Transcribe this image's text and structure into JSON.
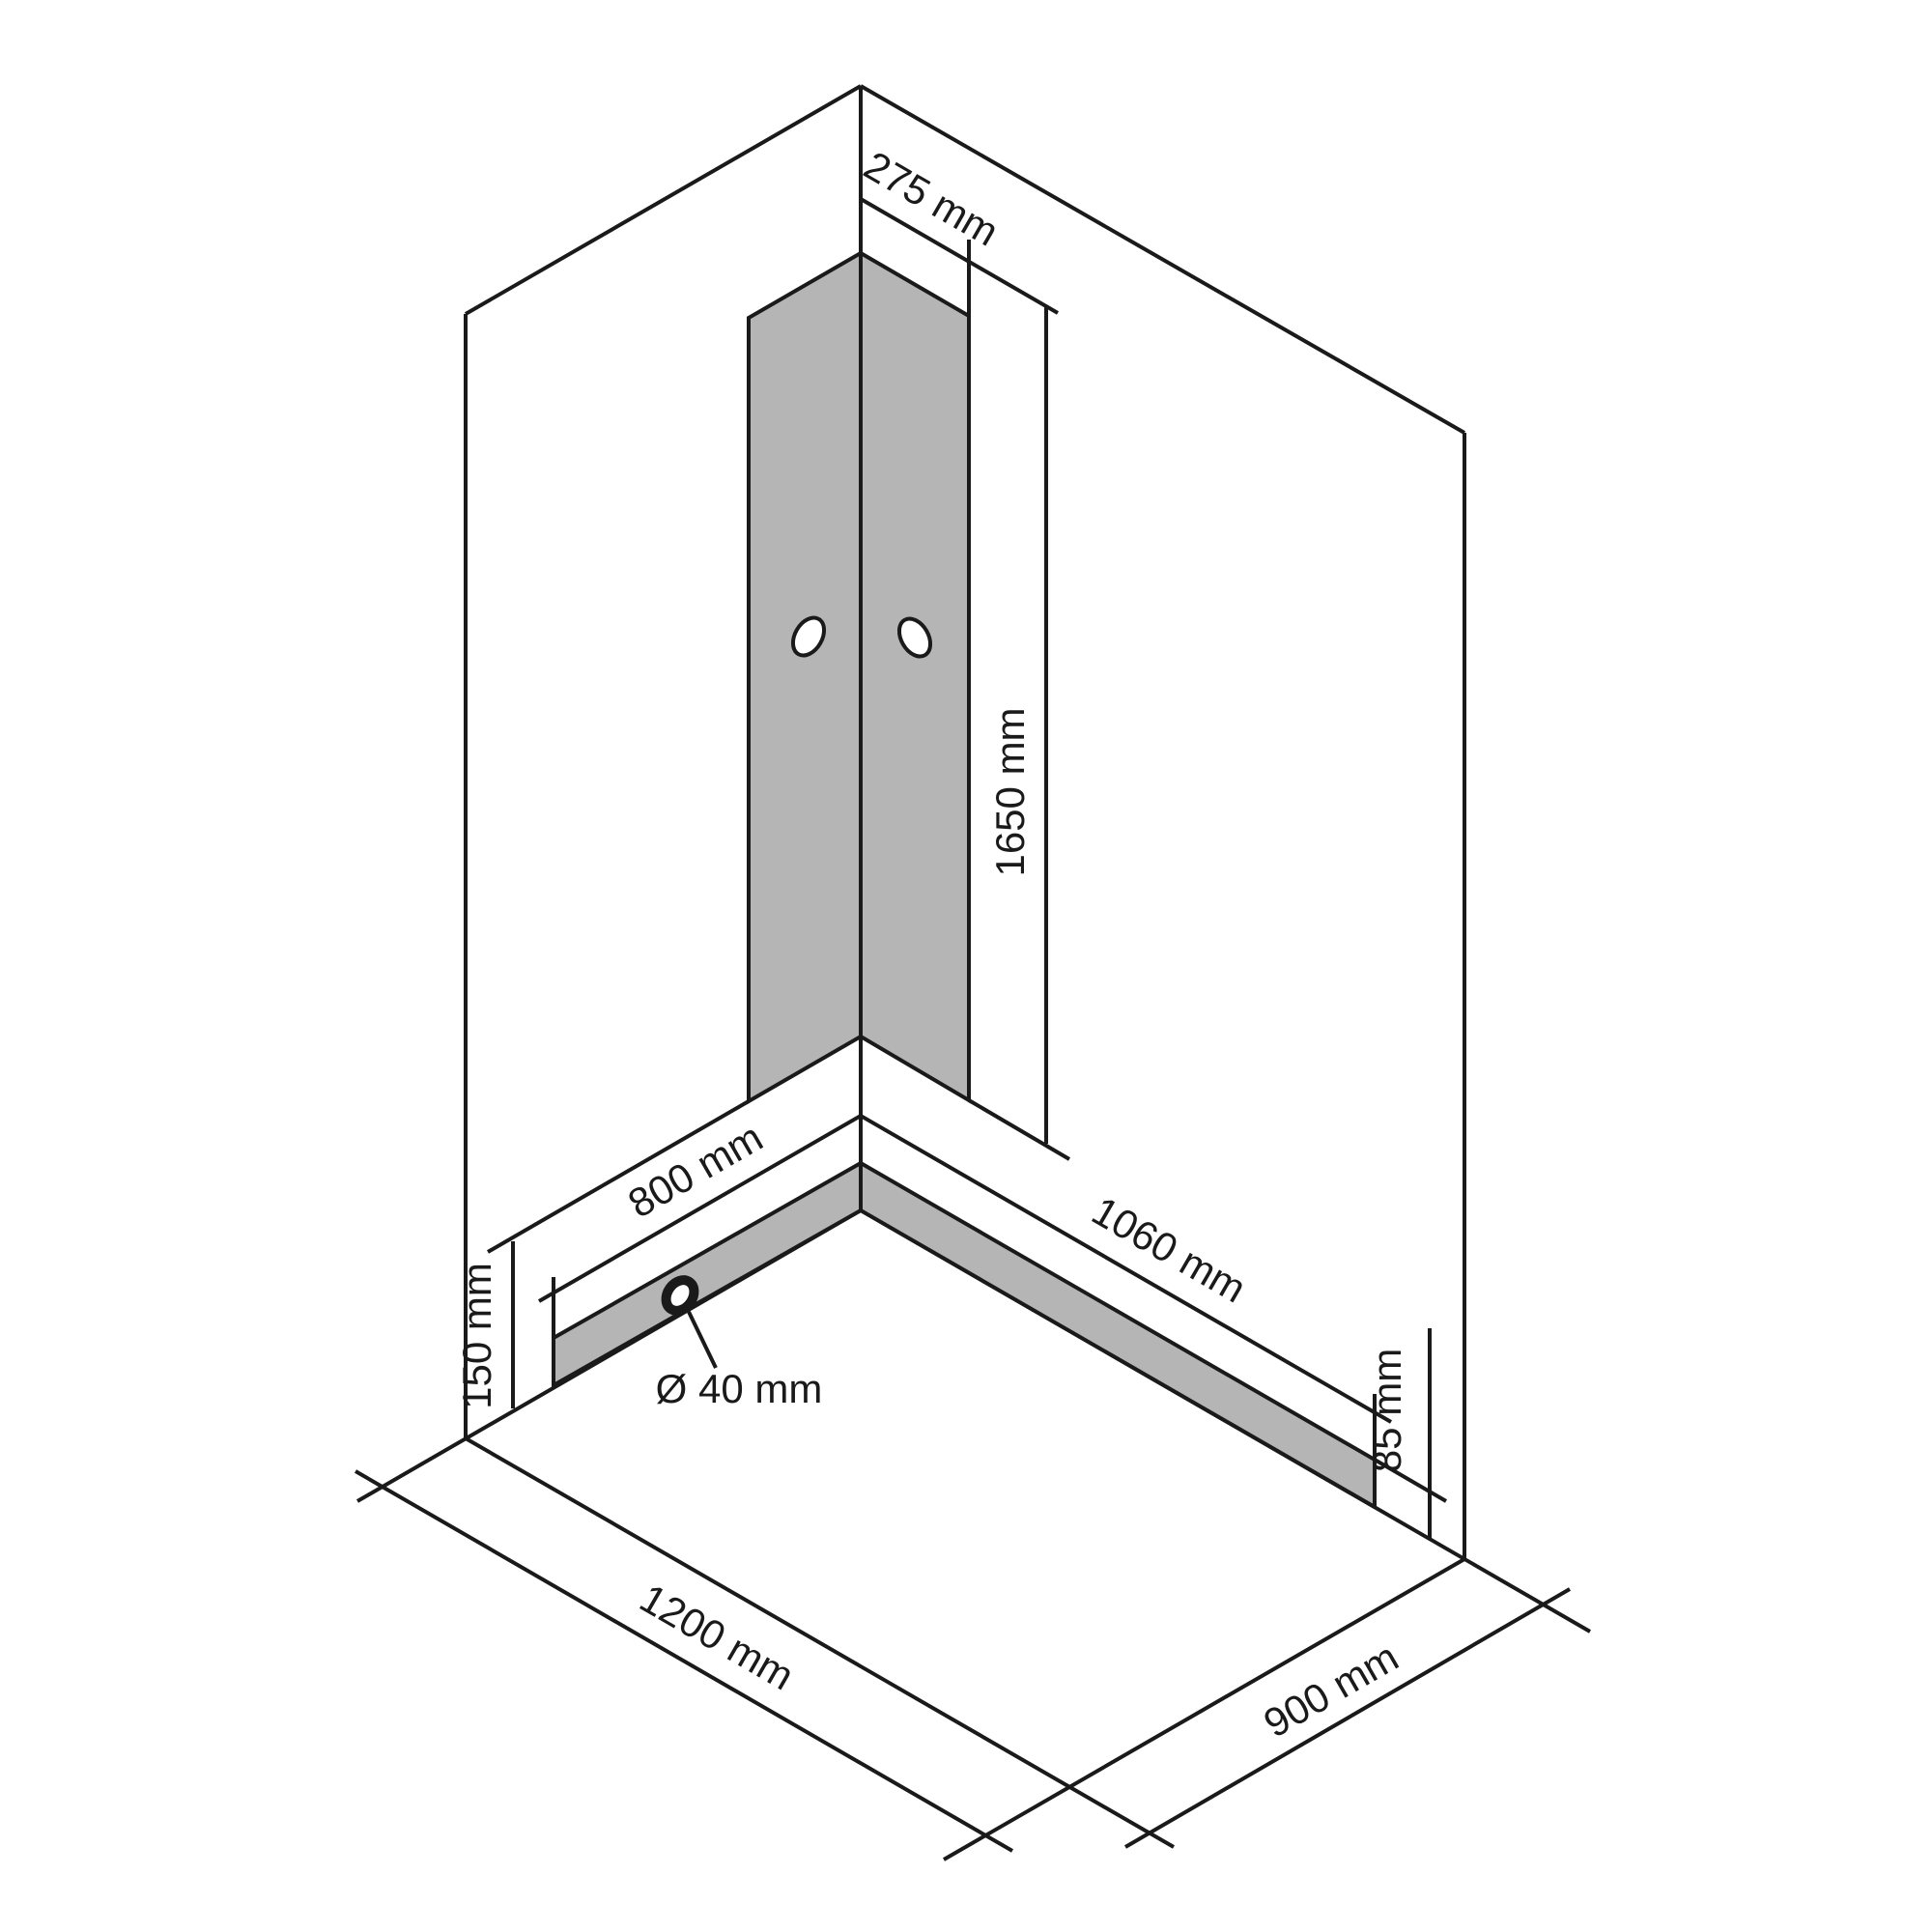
{
  "diagram": {
    "kind": "isometric-installation-drawing",
    "unit": "mm",
    "colors": {
      "line": "#1a1a1a",
      "panel_fill": "#b5b5b5",
      "background": "#ffffff"
    },
    "labels": {
      "panel_strip_width": "275 mm",
      "panel_strip_height": "1650 mm",
      "left_wall_span": "800 mm",
      "right_wall_span": "1060 mm",
      "strip_bottom_clearance": "150 mm",
      "apron_height": "85 mm",
      "drain_diameter": "Ø 40 mm",
      "floor_depth": "1200 mm",
      "floor_width": "900 mm"
    }
  }
}
